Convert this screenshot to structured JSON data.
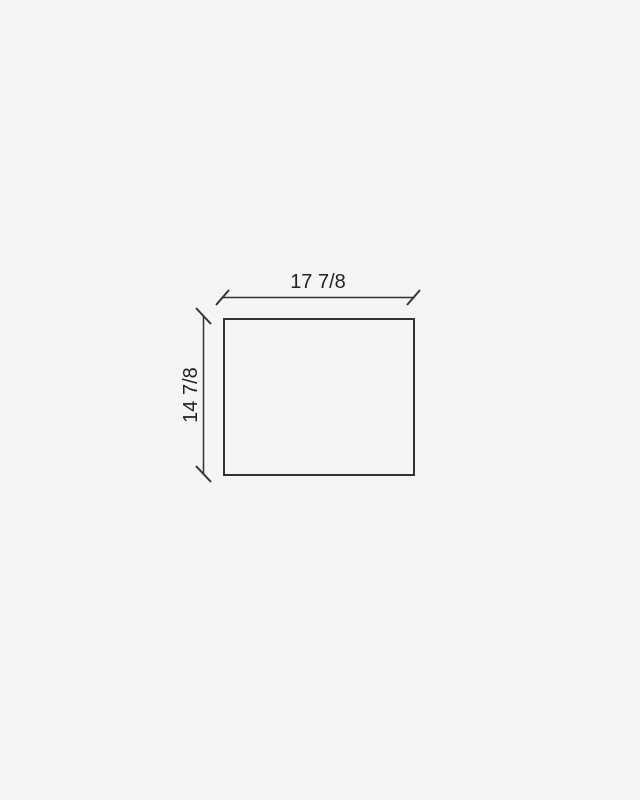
{
  "drawing": {
    "title": "rectangular-part-dimension-diagram",
    "width_label": "17 7/8",
    "height_label": "14 7/8",
    "colors": {
      "background": "#f5f5f5",
      "line": "#333333",
      "text": "#222222"
    }
  }
}
